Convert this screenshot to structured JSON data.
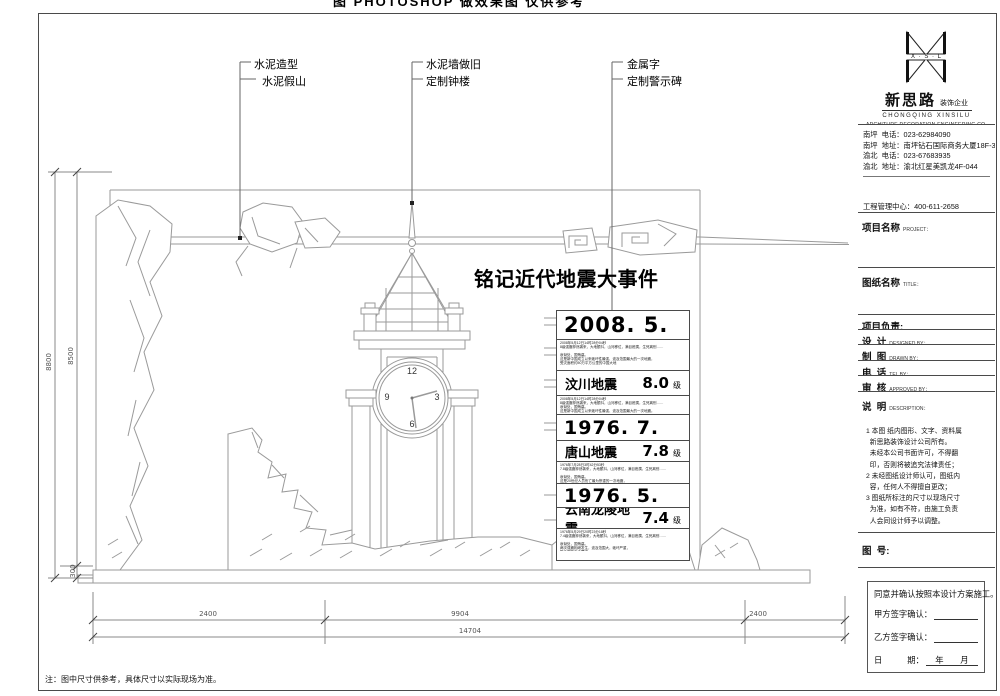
{
  "sheet": {
    "top_clipped_text": "图 PHOTOSHOP 做效果图 仅供参考",
    "bottom_note": "注：图中尺寸供参考，具体尺寸以实际现场为准。"
  },
  "callouts": {
    "group1_line1": "水泥造型",
    "group1_line2": "水泥假山",
    "group2_line1": "水泥墙做旧",
    "group2_line2": "定制钟楼",
    "group3_line1": "金属字",
    "group3_line2": "定制警示碑"
  },
  "wall": {
    "main_title": "铭记近代地震大事件",
    "clock": {
      "n12": "12",
      "n3": "3",
      "n6": "6",
      "n9": "9"
    }
  },
  "monument": {
    "events": [
      {
        "date": "2008. 5. 12",
        "name": "汶川地震",
        "magnitude": "8.0",
        "unit": "级"
      },
      {
        "date": "1976. 7. 28",
        "name": "唐山地震",
        "magnitude": "7.8",
        "unit": "级"
      },
      {
        "date": "1976. 5. 29",
        "name": "云南龙陵地震",
        "magnitude": "7.4",
        "unit": "级"
      }
    ],
    "micro": [
      "2008年5月12日14时28分04秒\n8级强震猝然袭来，大地颤抖，山河移位，满目疮痍，生死离别……\n\n哀恸处，国殇墓。\n这是新中国成立以来破坏性最强、波及范围最大的一次地震，\n受灾面积约50万平方公里的中国大地",
      "2008年5月12日14时28分04秒\n8级强震猝然袭来，大地颤抖，山河移位，满目疮痍，生死离别……\n哀恸处，国殇墓。\n这是新中国成立以来破坏性最强、波及范围最大的一次地震。",
      "1976年7月28日3时42分53秒\n7.8级强震猝然袭来，大地颤抖，山河移位，满目疮痍，生死离别……\n\n哀恸处，国殇墓。\n这是20世纪人员伤亡最为惨重的一次地震，\n数十万同胞在地震中不幸罹难",
      "1976年5月29日20时23分18秒\n7.4级强震猝然袭来，大地颤抖，山河移位，满目疮痍，生死离别……\n\n哀恸处，国殇墓。\n两次强震相继发生，波及范围大，破坏严重，\n数千同胞不幸罹难"
    ]
  },
  "dimensions": {
    "bottom_left": "2400",
    "bottom_mid": "9904",
    "bottom_right": "2400",
    "bottom_total": "14704",
    "left_total": "8800",
    "left_upper": "8500",
    "left_lower": "300"
  },
  "titleblock": {
    "logo_mark_text": "X · S · L",
    "company_cn": "新思路",
    "company_suffix": "装饰企业",
    "company_en1": "CHONGQING  XINSILU",
    "company_en2": "ARCHITURE  DECORATION  ENGINEERING  CO.",
    "contacts": [
      "南坪  电话：023-62984090",
      "南坪  地址：南坪钻石国际商务大厦18F-3",
      "渝北  电话：023-67683935",
      "渝北  地址：渝北红星美凯龙4F-044"
    ],
    "management": [
      "工程管理中心：400-611-2658",
      "南坪  地址：南坪钻石国际商务大厦10F-1"
    ],
    "fields": {
      "project_cn": "项目名称",
      "project_en": "PROJECT：",
      "sheet_cn": "图纸名称",
      "sheet_en": "TITLE：",
      "leader_cn": "项目负责:",
      "design_cn": "设  计",
      "design_en": "DESIGNED BY：",
      "draw_cn": "制  图",
      "draw_en": "DRAWN BY：",
      "tel_cn": "电  话",
      "tel_en": "TEL BY：",
      "approve_cn": "审  核",
      "approve_en": "APPROVED BY：",
      "desc_cn": "说  明",
      "desc_en": "DESCRIPTION：",
      "dwg_no": "图  号:"
    },
    "notes": [
      "1 本图 纸内图形、文字、资料属",
      "  新思路装饰设计公司所有。",
      "  未经本公司书面许可，不得翻",
      "  印，否则将被追究法律责任；",
      "2 未经图纸设计师认可，图纸内",
      "  容，任何人不得擅自更改；",
      "3 图纸所标注的尺寸以现场尺寸",
      "  为准，如有不符，由施工负责",
      "  人会同设计师予以调整。"
    ],
    "agreement": {
      "line1": "同意并确认按照本设计方案施工。",
      "party_a": "甲方签字确认：",
      "party_b": "乙方签字确认：",
      "date_label": "日　　　期：",
      "date_suffix": "年　　月"
    }
  }
}
